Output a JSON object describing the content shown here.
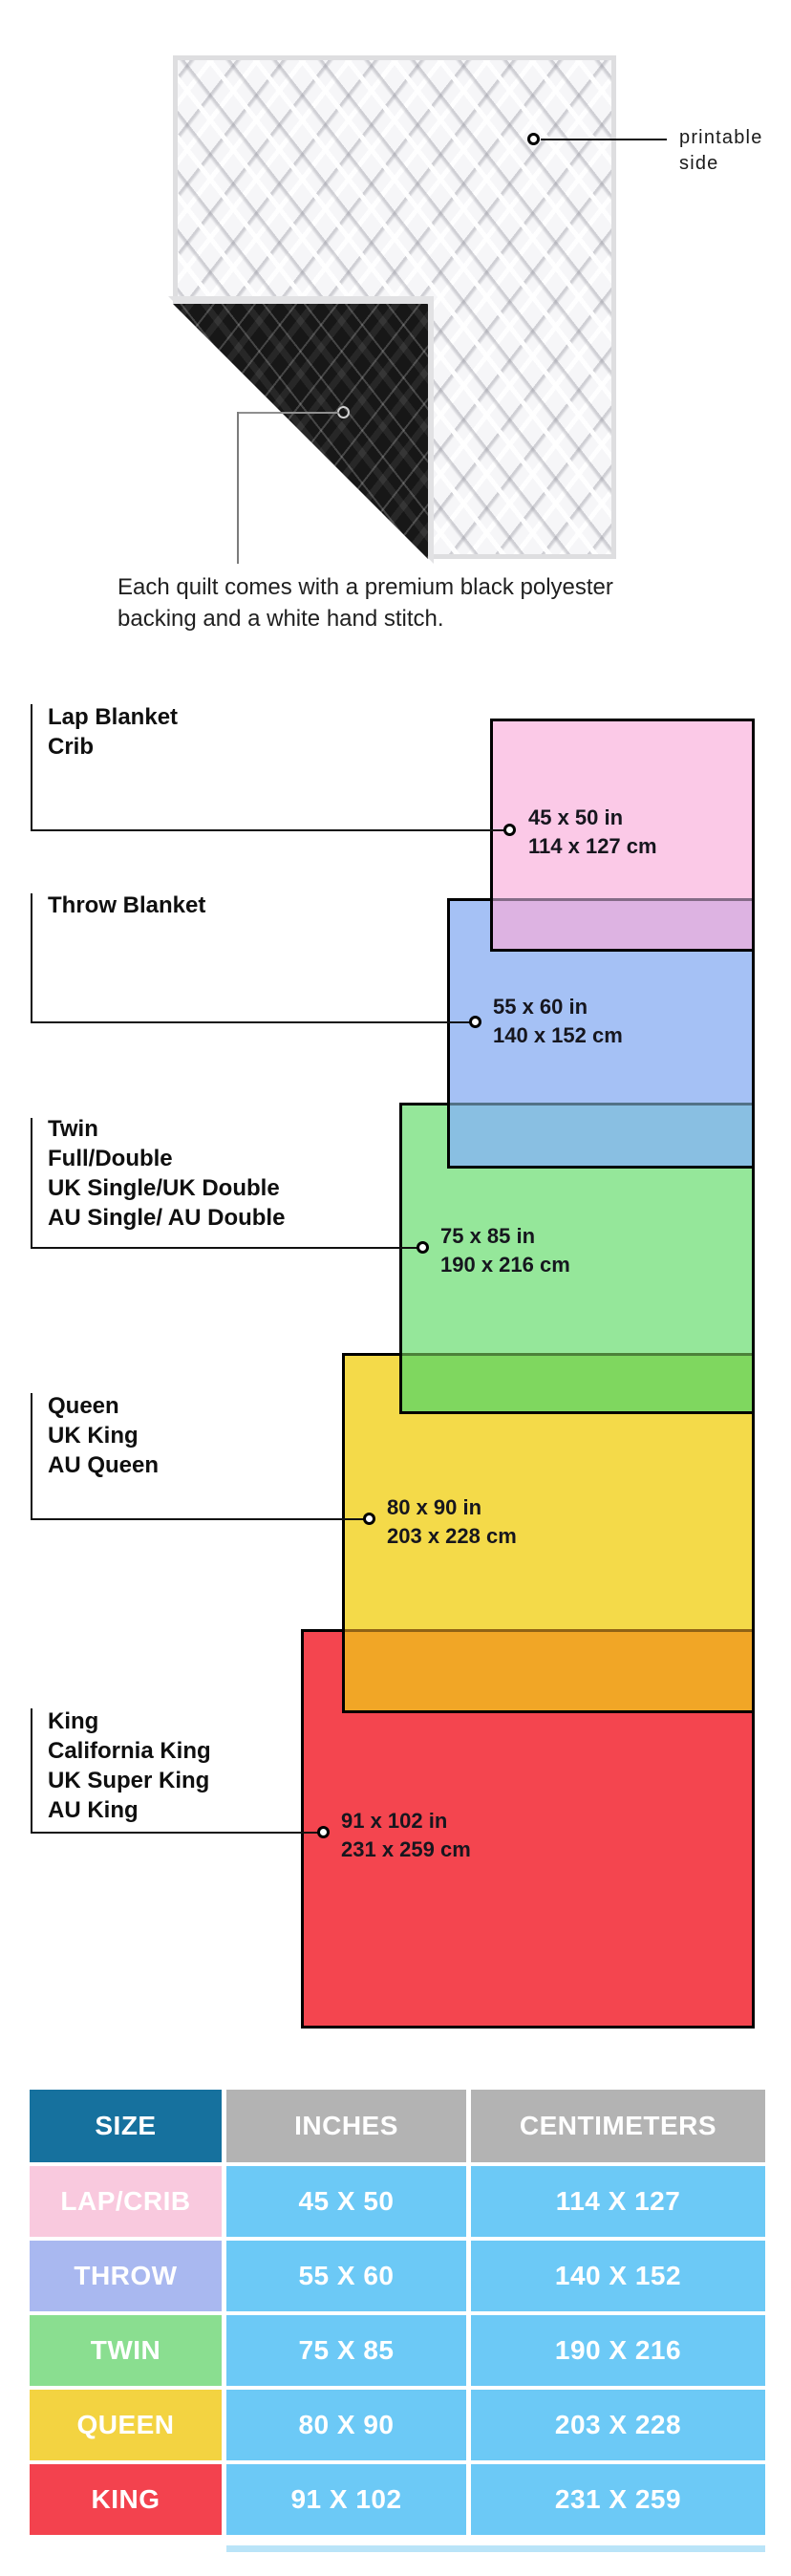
{
  "quilt": {
    "printable_label_line1": "printable",
    "printable_label_line2": "side",
    "caption_line1": "Each quilt comes with a premium black polyester",
    "caption_line2": "backing and a white hand stitch."
  },
  "diagram": {
    "sizes": [
      {
        "labels": [
          "Lap Blanket",
          "Crib"
        ],
        "inches": "45 x 50 in",
        "cm": "114 x 127 cm",
        "color": "#FBC9E7"
      },
      {
        "labels": [
          "Throw Blanket"
        ],
        "inches": "55 x 60 in",
        "cm": "140 x 152 cm",
        "color": "#A5C1F5"
      },
      {
        "labels": [
          "Twin",
          "Full/Double",
          "UK Single/UK Double",
          "AU Single/ AU Double"
        ],
        "inches": "75 x 85 in",
        "cm": "190 x 216 cm",
        "color": "#95E79A"
      },
      {
        "labels": [
          "Queen",
          "UK King",
          "AU Queen"
        ],
        "inches": "80 x 90 in",
        "cm": "203 x 228 cm",
        "color": "#F4DA49"
      },
      {
        "labels": [
          "King",
          "California King",
          "UK Super King",
          "AU King"
        ],
        "inches": "91 x 102 in",
        "cm": "231 x 259 cm",
        "color": "#F4454F"
      }
    ],
    "overlap_colors": {
      "pink_blue": "#DDB3E2",
      "blue_green": "#89BFE2",
      "green_yellow": "#7FD75F",
      "yellow_red": "#F1A626"
    }
  },
  "table": {
    "headers": [
      "SIZE",
      "INCHES",
      "CENTIMETERS"
    ],
    "header_colors": {
      "size_bg": "#16719E",
      "other_bg": "#B3B3B3"
    },
    "cell_bg": "#6CC9F6",
    "rows": [
      {
        "size": "LAP/CRIB",
        "inches": "45 X 50",
        "cm": "114 X 127",
        "color": "#F9C9DE"
      },
      {
        "size": "THROW",
        "inches": "55 X 60",
        "cm": "140 X 152",
        "color": "#A9B8F0"
      },
      {
        "size": "TWIN",
        "inches": "75 X 85",
        "cm": "190 X 216",
        "color": "#8ADE90"
      },
      {
        "size": "QUEEN",
        "inches": "80 X 90",
        "cm": "203 X 228",
        "color": "#F3D341"
      },
      {
        "size": "KING",
        "inches": "91 X 102",
        "cm": "231 X 259",
        "color": "#F3424E"
      }
    ]
  }
}
